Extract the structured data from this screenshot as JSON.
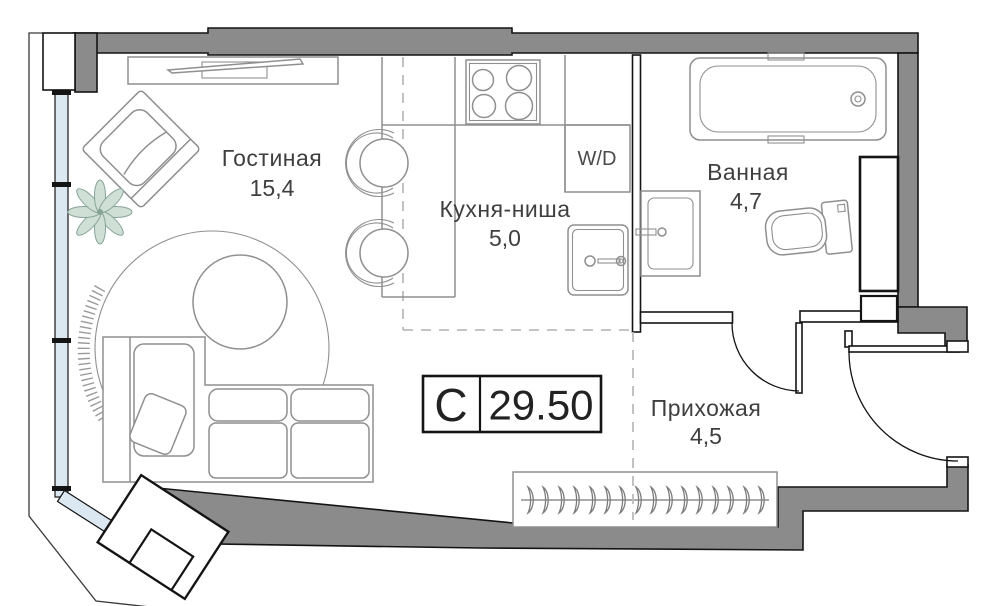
{
  "plan": {
    "type_label": "С",
    "total_area": "29.50",
    "rooms": [
      {
        "name": "Гостиная",
        "area": "15,4"
      },
      {
        "name": "Кухня-ниша",
        "area": "5,0"
      },
      {
        "name": "Ванная",
        "area": "4,7"
      },
      {
        "name": "Прихожая",
        "area": "4,5"
      }
    ],
    "labels": {
      "washer_dryer": "W/D"
    },
    "colors": {
      "wall_fill": "#8b8b8b",
      "furniture_line": "#8f8f8f",
      "glazing_fill": "#dce8f1",
      "plant_fill": "#cfdfd6",
      "plant_stroke": "#86a396",
      "text": "#3f3f3f"
    }
  }
}
